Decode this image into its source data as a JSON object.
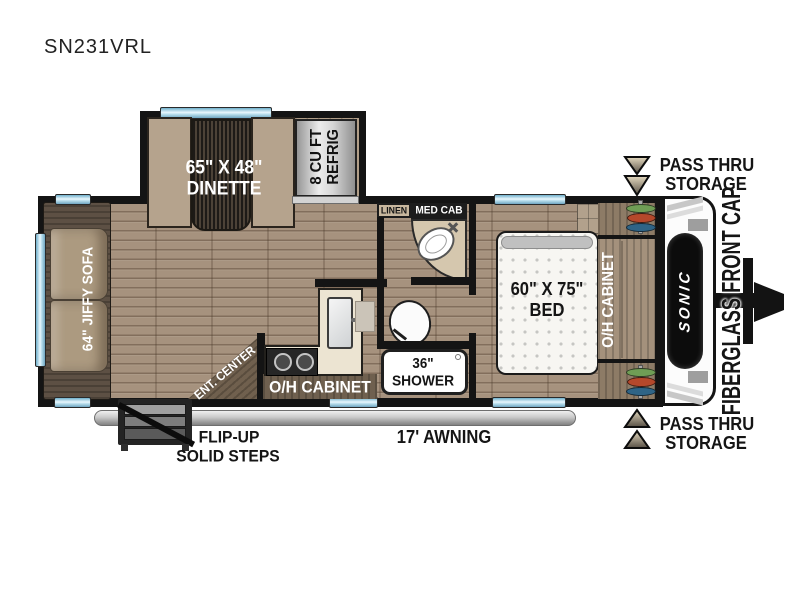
{
  "title": "SN231VRL",
  "floorplan": {
    "dinette": {
      "size": "65\" X 48\"",
      "name": "DINETTE"
    },
    "refrigerator": {
      "size": "8 CU FT",
      "name": "REFRIG"
    },
    "sofa": {
      "label": "64\" JIFFY SOFA"
    },
    "linen": {
      "label": "LINEN"
    },
    "med_cab": {
      "label": "MED CAB"
    },
    "bed": {
      "size": "60\" X 75\"",
      "name": "BED"
    },
    "bedroom_cabinet": {
      "label": "O/H CABINET"
    },
    "shower": {
      "size": "36\"",
      "name": "SHOWER"
    },
    "kitchen_cabinet": {
      "label": "O/H CABINET"
    },
    "ent_center": {
      "label": "ENT. CENTER"
    },
    "steps": {
      "line1": "FLIP-UP",
      "line2": "SOLID STEPS"
    },
    "awning": {
      "label": "17' AWNING"
    },
    "pass_thru_top": {
      "line1": "PASS THRU",
      "line2": "STORAGE"
    },
    "pass_thru_bottom": {
      "line1": "PASS THRU",
      "line2": "STORAGE"
    },
    "front_cap": {
      "label": "FIBERGLASS FRONT CAP"
    },
    "brand": {
      "label": "SONIC"
    }
  },
  "colors": {
    "wall": "#141414",
    "floor": "#a6927e",
    "furniture_tan": "#b5a38d",
    "dark_wood": "#5f5245",
    "counter_cream": "#ece4d2",
    "window_blue": "#8ec6de",
    "mattress_white": "#f7f6f2",
    "storage_green": "#6f9d55",
    "storage_red": "#b5482b",
    "storage_blue": "#2f6486"
  }
}
